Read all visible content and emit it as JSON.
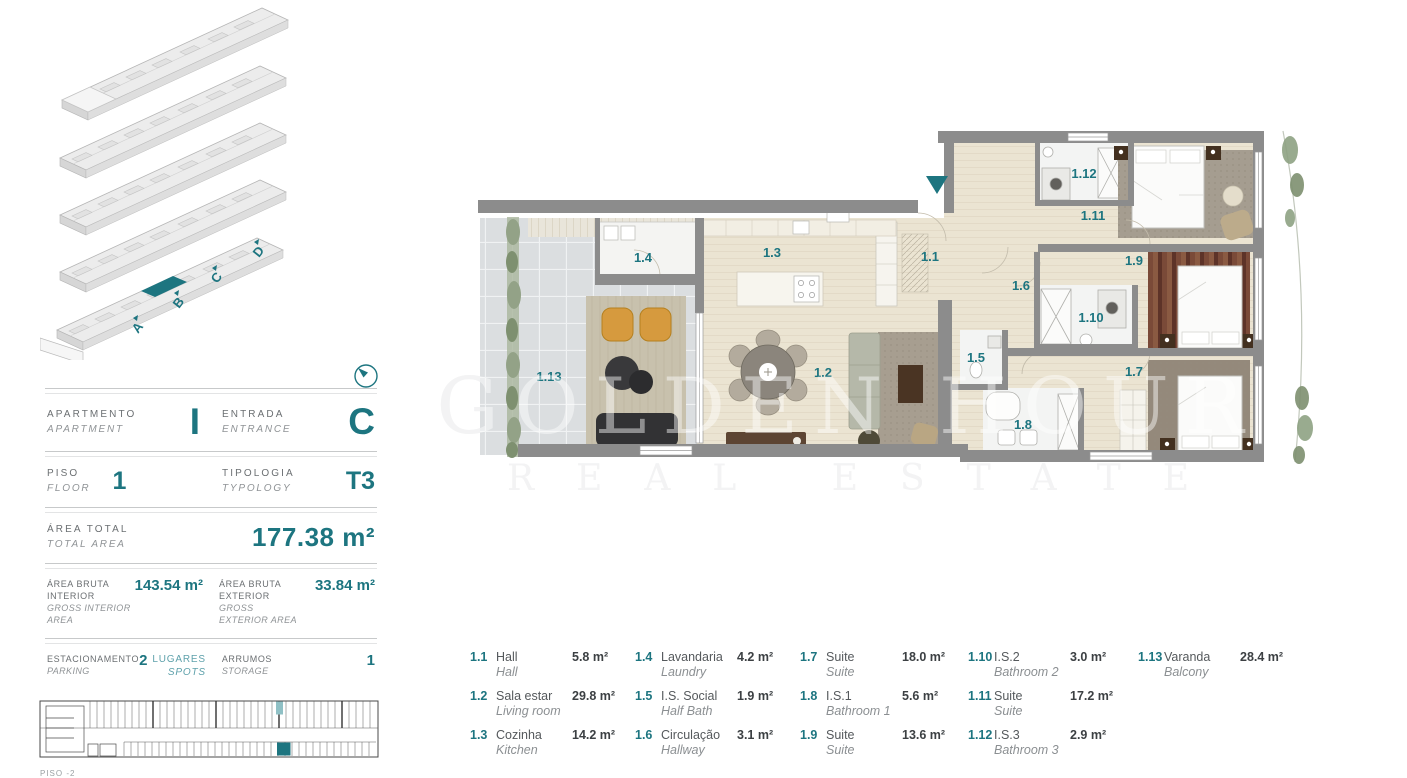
{
  "accent_color": "#1d7580",
  "watermark": {
    "line1": "GOLDEN HOUR",
    "line2": "REAL ESTATE"
  },
  "axon": {
    "entrances": [
      "A",
      "B",
      "C",
      "D"
    ]
  },
  "info_panel": {
    "apartment": {
      "label_pt": "APARTMENTO",
      "label_en": "APARTMENT",
      "value": "I"
    },
    "entrance": {
      "label_pt": "ENTRADA",
      "label_en": "ENTRANCE",
      "value": "C"
    },
    "floor": {
      "label_pt": "PISO",
      "label_en": "FLOOR",
      "value": "1"
    },
    "typology": {
      "label_pt": "TIPOLOGIA",
      "label_en": "TYPOLOGY",
      "value": "T3"
    },
    "total_area": {
      "label_pt": "ÁREA TOTAL",
      "label_en": "TOTAL AREA",
      "value": "177.38 m²"
    },
    "gross_interior": {
      "label_pt": "ÁREA BRUTA INTERIOR",
      "label_en": "GROSS INTERIOR AREA",
      "value": "143.54 m²"
    },
    "gross_exterior": {
      "label_pt": "ÁREA BRUTA EXTERIOR",
      "label_en": "GROSS EXTERIOR AREA",
      "value": "33.84 m²"
    },
    "parking": {
      "label_pt": "ESTACIONAMENTO",
      "label_en": "PARKING",
      "value": "2",
      "unit_pt": "LUGARES",
      "unit_en": "SPOTS"
    },
    "storage": {
      "label_pt": "ARRUMOS",
      "label_en": "STORAGE",
      "value": "1"
    }
  },
  "parking_plan": {
    "floor_label": "PISO -2"
  },
  "plan": {
    "labels": {
      "hall": "1.1",
      "living": "1.2",
      "kitchen": "1.3",
      "laundry": "1.4",
      "halfbath": "1.5",
      "hallway": "1.6",
      "suite1": "1.7",
      "bath1": "1.8",
      "suite2": "1.9",
      "bath2": "1.10",
      "suite3": "1.11",
      "bath3": "1.12",
      "balcony": "1.13"
    }
  },
  "legend": {
    "columns": [
      [
        {
          "num": "1.1",
          "pt": "Hall",
          "en": "Hall",
          "area": "5.8 m²"
        },
        {
          "num": "1.2",
          "pt": "Sala estar",
          "en": "Living room",
          "area": "29.8 m²"
        },
        {
          "num": "1.3",
          "pt": "Cozinha",
          "en": "Kitchen",
          "area": "14.2 m²"
        }
      ],
      [
        {
          "num": "1.4",
          "pt": "Lavandaria",
          "en": "Laundry",
          "area": "4.2 m²"
        },
        {
          "num": "1.5",
          "pt": "I.S. Social",
          "en": "Half Bath",
          "area": "1.9 m²"
        },
        {
          "num": "1.6",
          "pt": "Circulação",
          "en": "Hallway",
          "area": "3.1 m²"
        }
      ],
      [
        {
          "num": "1.7",
          "pt": "Suite",
          "en": "Suite",
          "area": "18.0 m²"
        },
        {
          "num": "1.8",
          "pt": "I.S.1",
          "en": "Bathroom 1",
          "area": "5.6 m²"
        },
        {
          "num": "1.9",
          "pt": "Suite",
          "en": "Suite",
          "area": "13.6 m²"
        }
      ],
      [
        {
          "num": "1.10",
          "pt": "I.S.2",
          "en": "Bathroom 2",
          "area": "3.0 m²"
        },
        {
          "num": "1.11",
          "pt": "Suite",
          "en": "Suite",
          "area": "17.2 m²"
        },
        {
          "num": "1.12",
          "pt": "I.S.3",
          "en": "Bathroom 3",
          "area": "2.9 m²"
        }
      ],
      [
        {
          "num": "1.13",
          "pt": "Varanda",
          "en": "Balcony",
          "area": "28.4 m²"
        }
      ]
    ]
  }
}
